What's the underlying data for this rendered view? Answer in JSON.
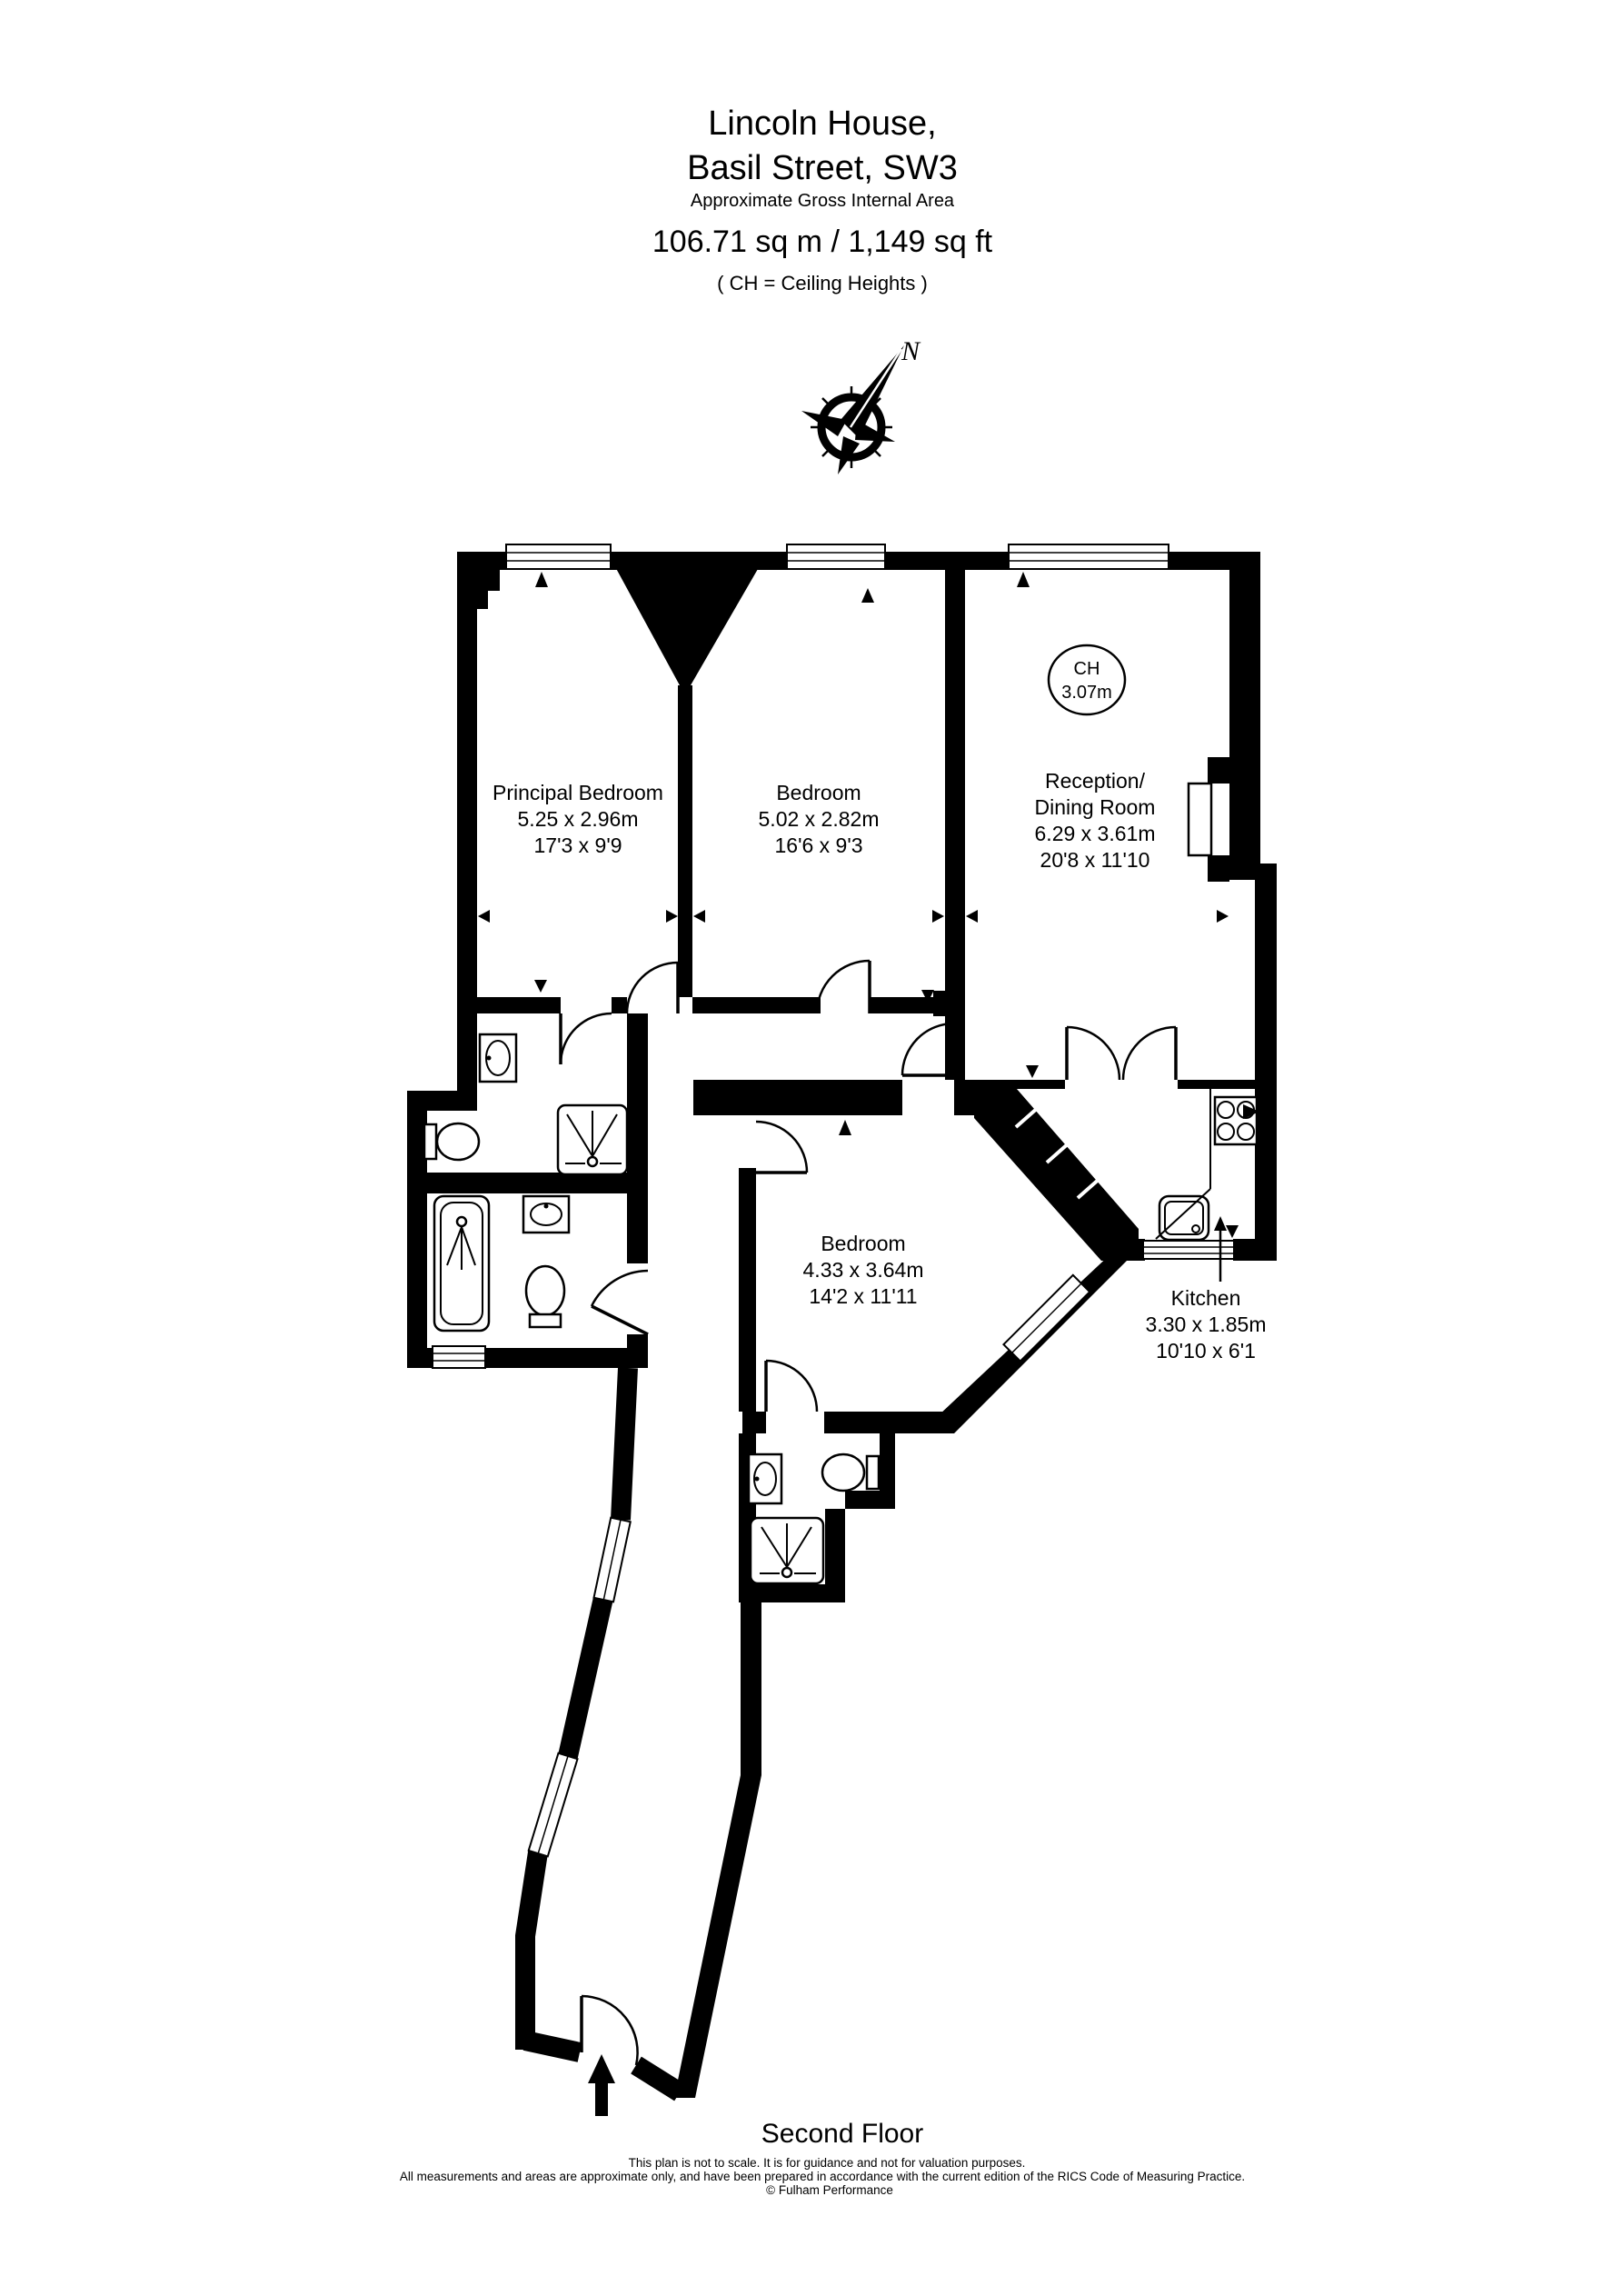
{
  "header": {
    "title_line1": "Lincoln House,",
    "title_line2": "Basil Street, SW3",
    "subtitle": "Approximate Gross Internal Area",
    "area": "106.71 sq m  /  1,149 sq ft",
    "ch_note": "( CH = Ceiling Heights )"
  },
  "compass": {
    "north_label": "N"
  },
  "rooms": {
    "principal_bedroom": {
      "name": "Principal Bedroom",
      "metric": "5.25 x 2.96m",
      "imperial": "17'3 x 9'9"
    },
    "bedroom2": {
      "name": "Bedroom",
      "metric": "5.02 x 2.82m",
      "imperial": "16'6 x 9'3"
    },
    "reception": {
      "name_line1": "Reception/",
      "name_line2": "Dining Room",
      "metric": "6.29 x 3.61m",
      "imperial": "20'8 x 11'10",
      "ceiling_height_label": "CH",
      "ceiling_height_value": "3.07m"
    },
    "bedroom3": {
      "name": "Bedroom",
      "metric": "4.33 x 3.64m",
      "imperial": "14'2 x 11'11"
    },
    "kitchen": {
      "name": "Kitchen",
      "metric": "3.30 x 1.85m",
      "imperial": "10'10 x 6'1"
    }
  },
  "footer": {
    "floor_label": "Second Floor",
    "disclaimer_line1": "This plan is not to scale. It is for guidance and not for valuation purposes.",
    "disclaimer_line2": "All measurements and areas are approximate only, and have been prepared in accordance with the current edition of the RICS Code of Measuring Practice.",
    "disclaimer_line3": "© Fulham Performance"
  },
  "colors": {
    "wall": "#000000",
    "background": "#ffffff"
  }
}
